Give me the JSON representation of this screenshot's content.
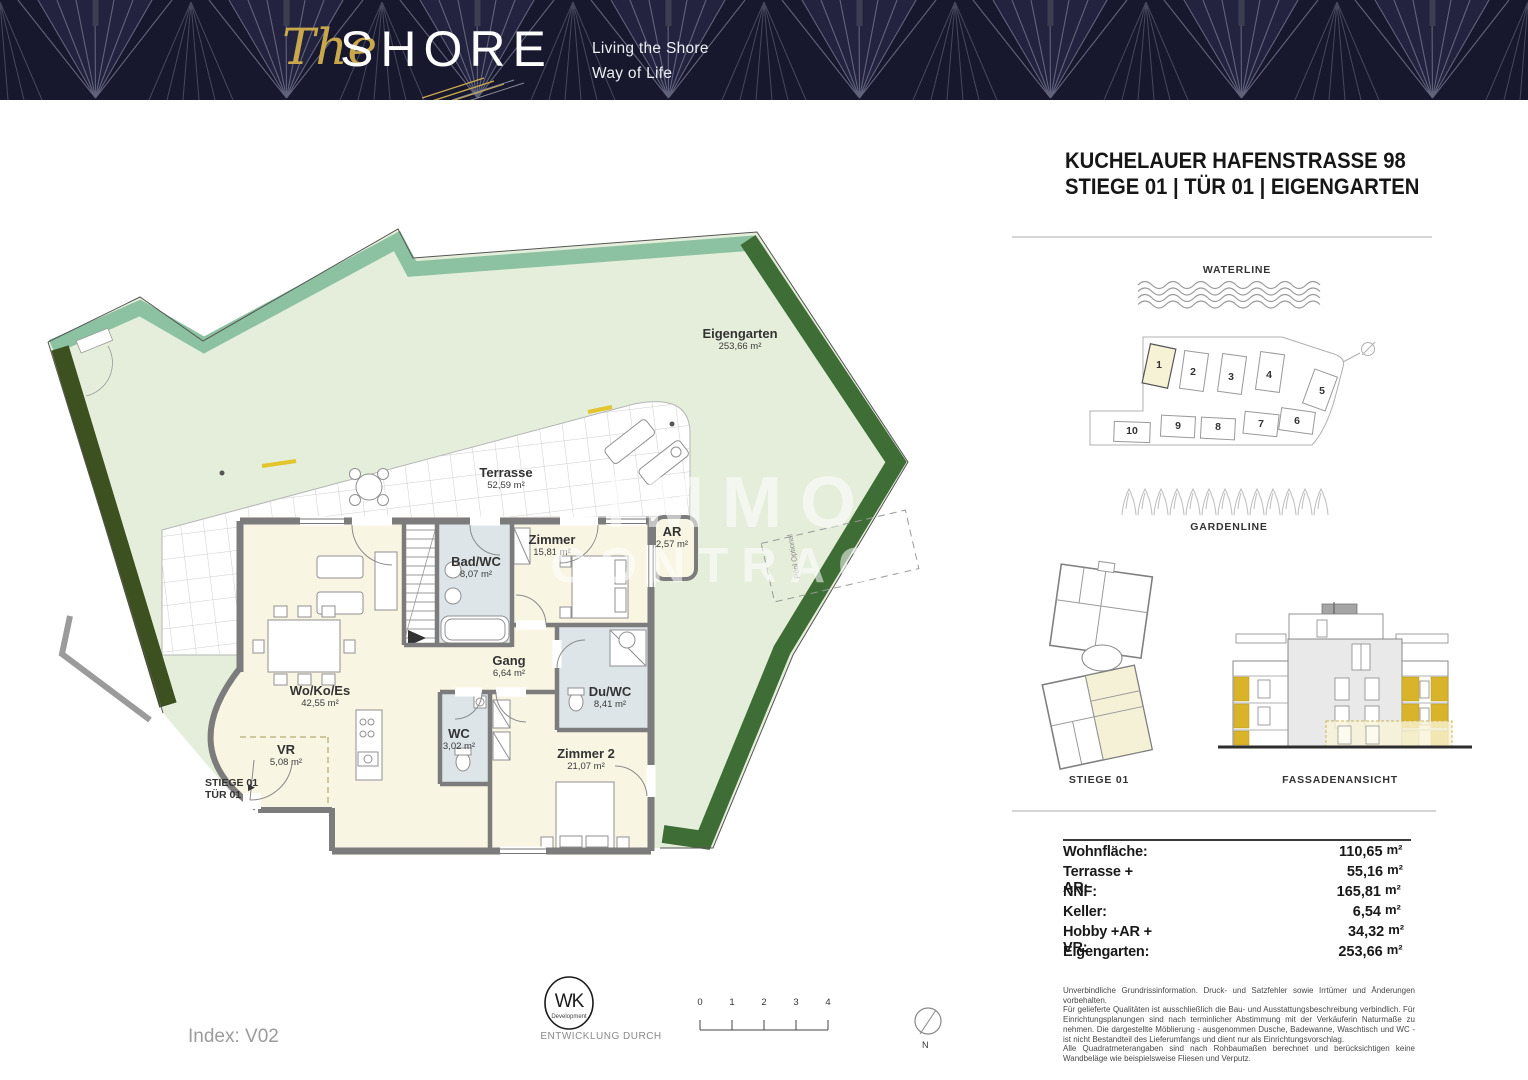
{
  "banner": {
    "logo_script": "The",
    "logo_main": "SHORE",
    "tagline1": "Living the Shore",
    "tagline2": "Way of Life"
  },
  "header": {
    "line1": "KUCHELAUER HAFENSTRASSE 98",
    "line2": "STIEGE 01 | TÜR 01 | EIGENGARTEN"
  },
  "plan": {
    "entrance1": "STIEGE 01",
    "entrance2": "TÜR 01",
    "entrance_arrow": "▶",
    "pool": "Pool Optional",
    "watermark1": "IMMO",
    "watermark2": "CONTRACT",
    "rooms": [
      {
        "name": "Eigengarten",
        "area": "253,66 m²"
      },
      {
        "name": "Terrasse",
        "area": "52,59 m²"
      },
      {
        "name": "Wo/Ko/Es",
        "area": "42,55 m²"
      },
      {
        "name": "Bad/WC",
        "area": "8,07 m²"
      },
      {
        "name": "Zimmer",
        "area": "15,81 m²"
      },
      {
        "name": "Gang",
        "area": "6,64 m²"
      },
      {
        "name": "Du/WC",
        "area": "8,41 m²"
      },
      {
        "name": "WC",
        "area": "3,02 m²"
      },
      {
        "name": "Zimmer 2",
        "area": "21,07 m²"
      },
      {
        "name": "VR",
        "area": "5,08 m²"
      },
      {
        "name": "AR",
        "area": "2,57 m²"
      }
    ]
  },
  "siteplan": {
    "waterline": "WATERLINE",
    "gardenline": "GARDENLINE",
    "buildings": [
      "1",
      "2",
      "3",
      "4",
      "5",
      "6",
      "7",
      "8",
      "9",
      "10"
    ]
  },
  "views": {
    "plan_label": "STIEGE 01",
    "facade_label": "FASSADENANSICHT"
  },
  "areas": {
    "rows": [
      {
        "label": "Wohnfläche:",
        "value": "110,65",
        "unit": "m²"
      },
      {
        "label": "Terrasse + AR:",
        "value": "55,16",
        "unit": "m²"
      },
      {
        "label": "NNF:",
        "value": "165,81",
        "unit": "m²"
      },
      {
        "label": "Keller:",
        "value": "6,54",
        "unit": "m²"
      },
      {
        "label": "Hobby +AR + VR:",
        "value": "34,32",
        "unit": "m²"
      },
      {
        "label": "Eigengarten:",
        "value": "253,66",
        "unit": "m²"
      }
    ]
  },
  "disclaimer": {
    "p1": "Unverbindliche Grundrissinformation. Druck- und Satzfehler sowie Irrtümer und Änderungen vorbehalten.",
    "p2": "Für gelieferte Qualitäten ist ausschließlich die Bau- und Ausstattungsbeschreibung verbindlich. Für Einrichtungsplanungen sind nach terminlicher Abstimmung mit der Verkäuferin Naturmaße zu nehmen. Die dargestellte Möblierung - ausgenommen Dusche, Badewanne, Waschtisch und WC - ist nicht Bestandteil des Lieferumfangs und dient nur als Einrichtungsvorschlag.",
    "p3": "Alle Quadratmeterangaben sind nach Rohbaumaßen berechnet und berücksichtigen keine Wandbeläge wie beispielsweise Fliesen und Verputz."
  },
  "footer": {
    "index": "Index: V02",
    "logo_monogram": "WK",
    "logo_sub": "Development",
    "entwicklung": "ENTWICKLUNG DURCH",
    "scale": [
      "0",
      "1",
      "2",
      "3",
      "4"
    ],
    "north": "N"
  }
}
